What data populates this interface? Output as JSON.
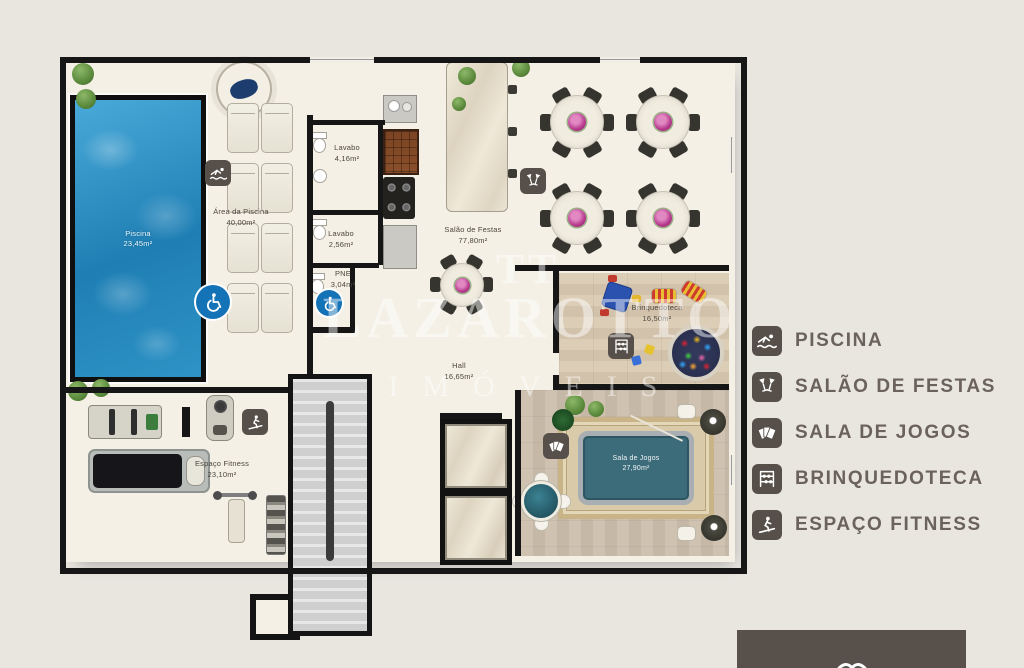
{
  "watermark": {
    "mark": "TT",
    "line1": "LAZAROTTO",
    "line2": "IMÓVEIS"
  },
  "legend": {
    "items": [
      {
        "id": "piscina",
        "label": "PISCINA",
        "icon": "swimmer-icon"
      },
      {
        "id": "salao-de-festas",
        "label": "SALÃO DE FESTAS",
        "icon": "cheers-glasses-icon"
      },
      {
        "id": "sala-de-jogos",
        "label": "SALA DE JOGOS",
        "icon": "playing-cards-icon"
      },
      {
        "id": "brinquedoteca",
        "label": "BRINQUEDOTECA",
        "icon": "abacus-toy-icon"
      },
      {
        "id": "espaco-fitness",
        "label": "ESPAÇO FITNESS",
        "icon": "treadmill-runner-icon"
      }
    ]
  },
  "rooms": {
    "piscina": {
      "name": "Piscina",
      "area": "23,45m²"
    },
    "area_da_piscina": {
      "name": "Área da Piscina",
      "area": "40,00m²"
    },
    "lavabo_1": {
      "name": "Lavabo",
      "area": "4,16m²"
    },
    "lavabo_2": {
      "name": "Lavabo",
      "area": "2,56m²"
    },
    "pne": {
      "name": "PNE",
      "area": "3,04m²"
    },
    "salao_de_festas": {
      "name": "Salão de Festas",
      "area": "77,80m²"
    },
    "brinquedoteca": {
      "name": "Brinquedoteca",
      "area": "16,50m²"
    },
    "hall": {
      "name": "Hall",
      "area": "16,65m²"
    },
    "sala_de_jogos": {
      "name": "Sala de Jogos",
      "area": "27,90m²"
    },
    "espaco_fitness": {
      "name": "Espaço Fitness",
      "area": "23,10m²"
    }
  },
  "colors": {
    "wall": "#161616",
    "floor": "#f4f0e5",
    "pool_water": "#2e93c6",
    "accessibility_blue": "#1472b7",
    "wood_floor": "#d5c5ae",
    "legend_icon_bg": "#57504a",
    "legend_text": "#6b635b",
    "brand_box": "#58504a",
    "page_background": "#e9e6e0"
  }
}
